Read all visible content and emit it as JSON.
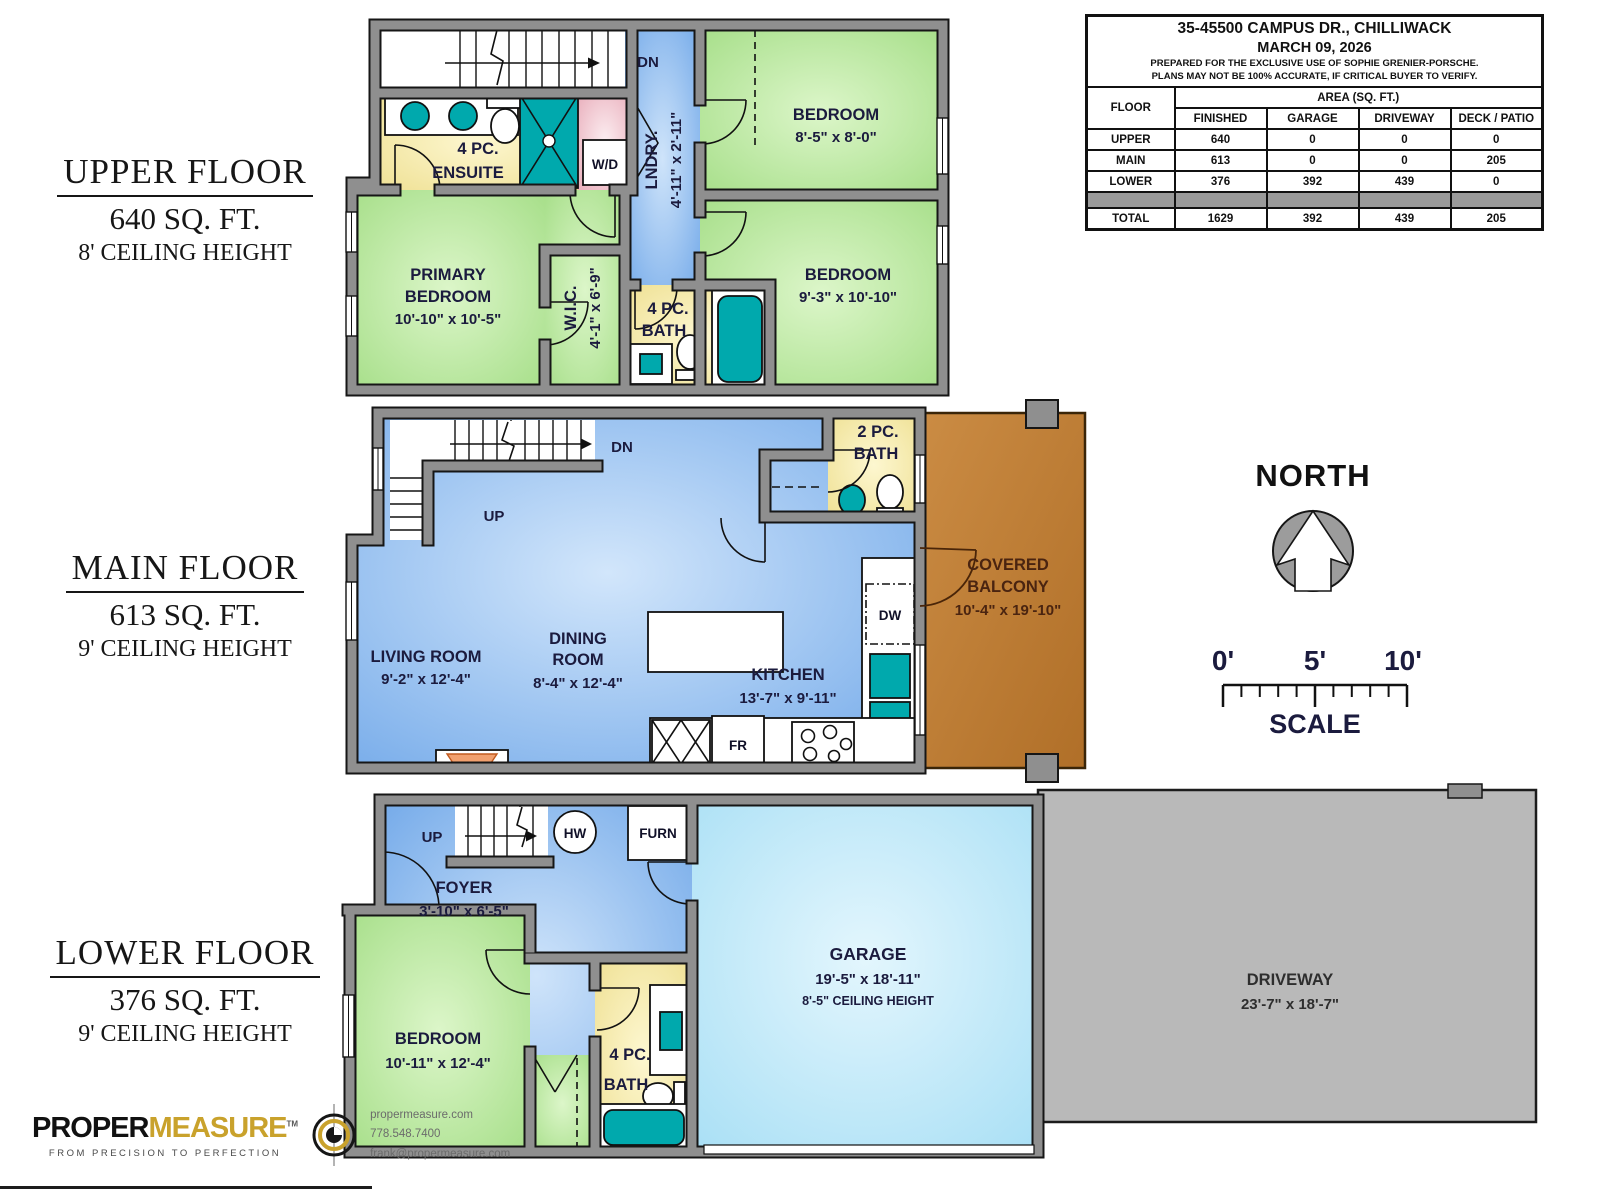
{
  "info": {
    "title": "35-45500 CAMPUS DR., CHILLIWACK",
    "date": "MARCH 09, 2026",
    "note1": "PREPARED FOR THE EXCLUSIVE USE OF SOPHIE GRENIER-PORSCHE.",
    "note2": "PLANS MAY NOT BE 100% ACCURATE, IF CRITICAL BUYER TO VERIFY.",
    "floor_label": "FLOOR",
    "area_label": "AREA (SQ. FT.)",
    "cols": [
      "FINISHED",
      "GARAGE",
      "DRIVEWAY",
      "DECK / PATIO"
    ],
    "rows": [
      [
        "UPPER",
        "640",
        "0",
        "0",
        "0"
      ],
      [
        "MAIN",
        "613",
        "0",
        "0",
        "205"
      ],
      [
        "LOWER",
        "376",
        "392",
        "439",
        "0"
      ]
    ],
    "total": [
      "TOTAL",
      "1629",
      "392",
      "439",
      "205"
    ]
  },
  "titles": {
    "upper": {
      "n": "UPPER FLOOR",
      "a": "640 SQ. FT.",
      "c": "8' CEILING HEIGHT"
    },
    "main": {
      "n": "MAIN FLOOR",
      "a": "613 SQ. FT.",
      "c": "9' CEILING HEIGHT"
    },
    "lower": {
      "n": "LOWER FLOOR",
      "a": "376 SQ. FT.",
      "c": "9' CEILING HEIGHT"
    }
  },
  "uf": {
    "dn": "DN",
    "lndry1": "LNDRY.",
    "lndry2": "4'-11\" x 2'-11\"",
    "bed1a": "BEDROOM",
    "bed1b": "8'-5\" x 8'-0\"",
    "ens1": "4 PC.",
    "ens2": "ENSUITE",
    "wd": "W/D",
    "prim1": "PRIMARY",
    "prim2": "BEDROOM",
    "prim3": "10'-10\" x 10'-5\"",
    "wic1": "W.I.C.",
    "wic2": "4'-1\" x 6'-9\"",
    "bath1": "4 PC.",
    "bath2": "BATH",
    "bed2a": "BEDROOM",
    "bed2b": "9'-3\" x 10'-10\""
  },
  "mf": {
    "dn": "DN",
    "up": "UP",
    "bath1": "2 PC.",
    "bath2": "BATH",
    "liv1": "LIVING ROOM",
    "liv2": "9'-2\" x 12'-4\"",
    "din1": "DINING",
    "din2": "ROOM",
    "din3": "8'-4\" x 12'-4\"",
    "kit1": "KITCHEN",
    "kit2": "13'-7\" x 9'-11\"",
    "dw": "DW",
    "fr": "FR",
    "balc1": "COVERED",
    "balc2": "BALCONY",
    "balc3": "10'-4\" x 19'-10\""
  },
  "lf": {
    "up": "UP",
    "hw": "HW",
    "furn": "FURN",
    "foyer1": "FOYER",
    "foyer2": "3'-10\" x 6'-5\"",
    "bed1": "BEDROOM",
    "bed2": "10'-11\" x 12'-4\"",
    "bath1": "4 PC.",
    "bath2": "BATH",
    "gar1": "GARAGE",
    "gar2": "19'-5\" x 18'-11\"",
    "gar3": "8'-5\" CEILING HEIGHT",
    "drv1": "DRIVEWAY",
    "drv2": "23'-7\" x 18'-7\""
  },
  "compass": {
    "north": "NORTH"
  },
  "scalebar": {
    "z": "0'",
    "f": "5'",
    "t": "10'",
    "label": "SCALE"
  },
  "brand": {
    "b1": "PROPER",
    "b2": "MEASURE",
    "tm": "TM",
    "tag": "FROM PRECISION TO PERFECTION",
    "web": "propermeasure.com",
    "tel": "778.548.7400",
    "mail": "frank@propermeasure.com"
  },
  "colors": {
    "wall": "#8f8f8f",
    "green": "#a9e18b",
    "blue": "#74a9e6",
    "garage_blue": "#aee3f7",
    "yellow": "#f3e6a0",
    "pink": "#eebac4",
    "teal": "#00a9ad",
    "balcony": "#bf7c33",
    "driveway": "#b9b9b9",
    "gold": "#c9a22c"
  }
}
